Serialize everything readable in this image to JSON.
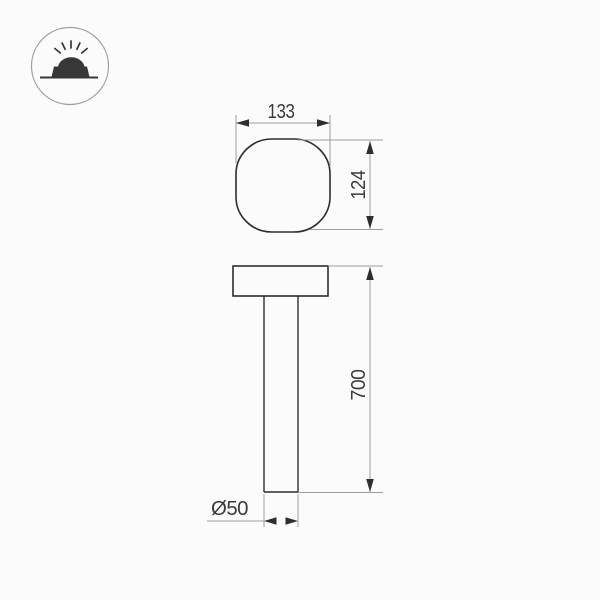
{
  "page": {
    "background": "#fbfbfb",
    "description_label": ""
  },
  "icon": {
    "name": "recessed-ground-light-icon"
  },
  "drawing": {
    "top_view": {
      "width_label": "133",
      "height_label": "124"
    },
    "side_view": {
      "pole_height_label": "700",
      "pole_diameter_label": "Ø50"
    }
  },
  "colors": {
    "outline": "#2e2e2e",
    "dim": "#9d9d9d",
    "txt": "#3a3a3a",
    "icon": "#373737",
    "icon-circle": "#a0a0a0",
    "bg": "#fbfbfb"
  }
}
